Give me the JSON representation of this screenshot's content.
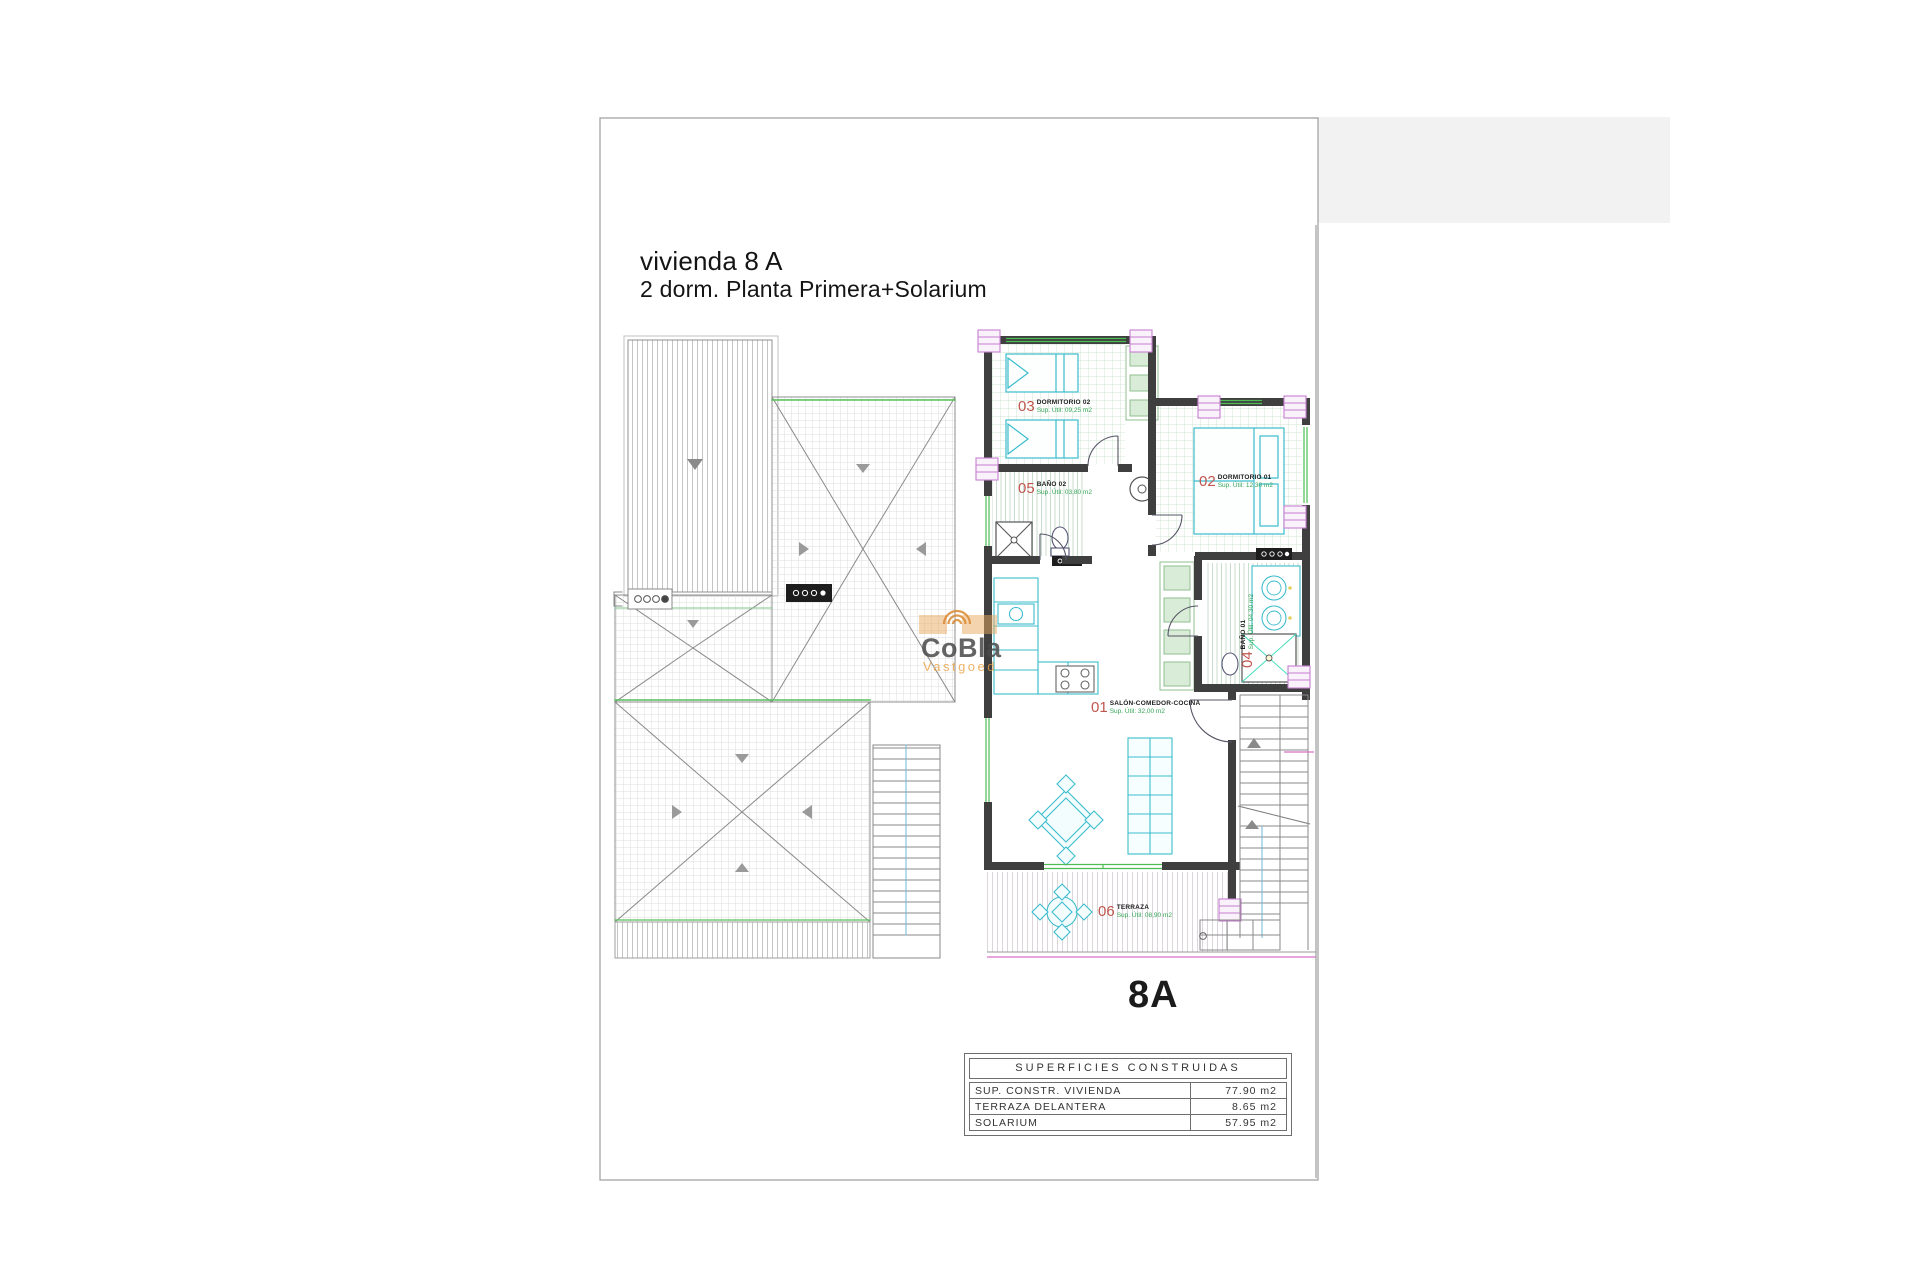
{
  "sheet": {
    "title": "vivienda 8 A",
    "subtitle": "2 dorm.  Planta Primera+Solarium",
    "unit_label": "8A"
  },
  "watermark": {
    "name": "CoBla",
    "tagline": "Vastgoed"
  },
  "rooms": [
    {
      "number": "03",
      "name": "DORMITORIO 02",
      "area": "Sup. Útil: 09,25 m2"
    },
    {
      "number": "05",
      "name": "BAÑO 02",
      "area": "Sup. Útil: 03,80 m2"
    },
    {
      "number": "02",
      "name": "DORMITORIO 01",
      "area": "Sup. Útil: 12,30 m2"
    },
    {
      "number": "04",
      "name": "BAÑO 01",
      "area": "Sup. Útil: 04,30 m2"
    },
    {
      "number": "01",
      "name": "SALÓN-COMEDOR-COCINA",
      "area": "Sup. Útil: 32,00 m2"
    },
    {
      "number": "06",
      "name": "TERRAZA",
      "area": "Sup. Útil: 08,90 m2"
    }
  ],
  "areas_table": {
    "title": "SUPERFICIES CONSTRUIDAS",
    "rows": [
      {
        "label": "SUP. CONSTR. VIVIENDA",
        "value": "77.90 m2"
      },
      {
        "label": "TERRAZA DELANTERA",
        "value": "8.65 m2"
      },
      {
        "label": "SOLARIUM",
        "value": "57.95 m2"
      }
    ]
  },
  "colors": {
    "wall": "#3f3f3f",
    "fixture_cyan": "#3bbccc",
    "window_green": "#4dbd53",
    "label_red": "#c0564e",
    "label_green": "#35a457",
    "column_pink": "#c77fd0",
    "boundary_magenta": "#d86fc8",
    "watermark_orange": "#e8a040"
  }
}
